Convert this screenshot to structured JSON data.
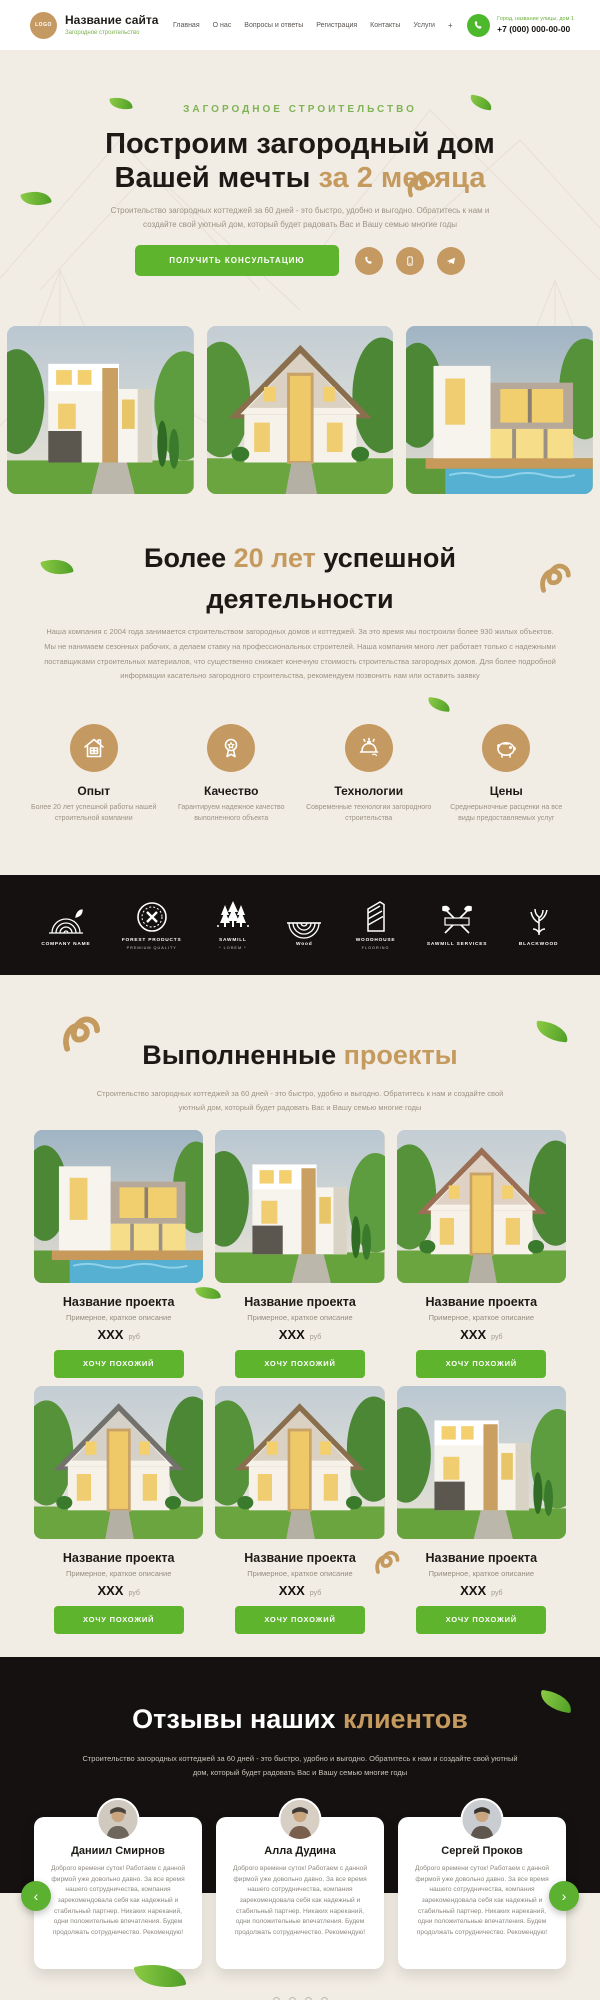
{
  "header": {
    "logo_text": "LOGO",
    "site_name": "Название сайта",
    "tagline": "Загородное строительство",
    "nav": [
      "Главная",
      "О нас",
      "Вопросы и ответы",
      "Регистрация",
      "Контакты",
      "Услуги"
    ],
    "nav_more": "+",
    "address": "Город, название улицы, дом 1",
    "phone": "+7 (000) 000-00-00"
  },
  "hero": {
    "kicker": "ЗАГОРОДНОЕ СТРОИТЕЛЬСТВО",
    "title_line1": "Построим загородный дом",
    "title_line2": "Вашей мечты",
    "title_line2_gold": "за 2 месяца",
    "subtitle": "Строительство загородных коттеджей за 60 дней - это быстро, удобно и выгодно. Обратитесь к нам и создайте свой уютный дом, который будет радовать Вас и Вашу семью многие годы",
    "cta": "ПОЛУЧИТЬ КОНСУЛЬТАЦИЮ",
    "socials": [
      {
        "icon": "whatsapp-icon"
      },
      {
        "icon": "viber-icon"
      },
      {
        "icon": "telegram-icon"
      }
    ]
  },
  "about": {
    "title_pre": "Более",
    "title_gold": "20 лет",
    "title_post": "успешной деятельности",
    "text": "Наша компания с 2004 года занимается строительством загородных домов и коттеджей. За это время мы построили более 930 жилых объектов. Мы не нанимаем сезонных рабочих, а делаем ставку на профессиональных строителей. Наша компания много лет работает только с надежными поставщиками строительных материалов, что существенно снижает конечную стоимость строительства загородных домов. Для более подробной информации касательно загородного строительства, рекомендуем позвонить нам или оставить заявку",
    "features": [
      {
        "icon": "house-icon",
        "title": "Опыт",
        "text": "Более 20 лет успешной работы нашей строительной компании"
      },
      {
        "icon": "award-icon",
        "title": "Качество",
        "text": "Гарантируем надежное качество выполненного объекта"
      },
      {
        "icon": "helmet-icon",
        "title": "Технологии",
        "text": "Современные технологии загородного строительства"
      },
      {
        "icon": "piggy-bank-icon",
        "title": "Цены",
        "text": "Среднерыночные расценки на все виды предоставляемых услуг"
      }
    ]
  },
  "partners": [
    {
      "icon": "log-rings-icon",
      "name": "COMPANY NAME",
      "sub": ""
    },
    {
      "icon": "round-badge-icon",
      "name": "FOREST PRODUCTS",
      "sub": "PREMIUM QUALITY"
    },
    {
      "icon": "pine-trees-icon",
      "name": "SAWMILL",
      "sub": "* LOREM *"
    },
    {
      "icon": "half-log-icon",
      "name": "Wood",
      "sub": ""
    },
    {
      "icon": "wood-house-icon",
      "name": "WOODHOUSE",
      "sub": "FLOORING"
    },
    {
      "icon": "crossed-axes-icon",
      "name": "SAWMILL SERVICES",
      "sub": ""
    },
    {
      "icon": "oak-tree-icon",
      "name": "BLACKWOOD",
      "sub": ""
    }
  ],
  "projects": {
    "title": "Выполненные",
    "title_gold": "проекты",
    "subtitle": "Строительство загородных коттеджей за 60 дней - это быстро, удобно и выгодно. Обратитесь к нам и создайте свой уютный дом, который будет радовать Вас и Вашу семью многие годы",
    "cards": [
      {
        "title": "Название проекта",
        "desc": "Примерное, краткое описание",
        "price": "XXX",
        "currency": "руб",
        "button": "ХОЧУ ПОХОЖИЙ"
      },
      {
        "title": "Название проекта",
        "desc": "Примерное, краткое описание",
        "price": "XXX",
        "currency": "руб",
        "button": "ХОЧУ ПОХОЖИЙ"
      },
      {
        "title": "Название проекта",
        "desc": "Примерное, краткое описание",
        "price": "XXX",
        "currency": "руб",
        "button": "ХОЧУ ПОХОЖИЙ"
      },
      {
        "title": "Название проекта",
        "desc": "Примерное, краткое описание",
        "price": "XXX",
        "currency": "руб",
        "button": "ХОЧУ ПОХОЖИЙ"
      },
      {
        "title": "Название проекта",
        "desc": "Примерное, краткое описание",
        "price": "XXX",
        "currency": "руб",
        "button": "ХОЧУ ПОХОЖИЙ"
      },
      {
        "title": "Название проекта",
        "desc": "Примерное, краткое описание",
        "price": "XXX",
        "currency": "руб",
        "button": "ХОЧУ ПОХОЖИЙ"
      }
    ]
  },
  "reviews": {
    "title": "Отзывы наших",
    "title_gold": "клиентов",
    "subtitle": "Строительство загородных коттеджей за 60 дней - это быстро, удобно и выгодно. Обратитесь к нам и создайте свой уютный дом, который будет радовать Вас и Вашу семью многие годы",
    "items": [
      {
        "name": "Даниил Смирнов",
        "text": "Доброго времени суток! Работаем с данной фирмой уже довольно давно. За все время нашего сотрудничества, компания зарекомендовала себя как надежный и стабильный партнер. Никаких нареканий, одни положительные впечатления. Будем продолжать сотрудничество. Рекомендую!"
      },
      {
        "name": "Алла Дудина",
        "text": "Доброго времени суток! Работаем с данной фирмой уже довольно давно. За все время нашего сотрудничества, компания зарекомендовала себя как надежный и стабильный партнер. Никаких нареканий, одни положительные впечатления. Будем продолжать сотрудничество. Рекомендую!"
      },
      {
        "name": "Сергей Проков",
        "text": "Доброго времени суток! Работаем с данной фирмой уже довольно давно. За все время нашего сотрудничества, компания зарекомендовала себя как надежный и стабильный партнер. Никаких нареканий, одни положительные впечатления. Будем продолжать сотрудничество. Рекомендую!"
      }
    ],
    "prev_arrow": "‹",
    "next_arrow": "›",
    "dots_count": 4
  },
  "colors": {
    "accent_green": "#5eb42c",
    "accent_gold": "#c59a5f",
    "tan": "#c59a62",
    "cream_bg": "#f2ede4",
    "dark_section": "#141110"
  }
}
